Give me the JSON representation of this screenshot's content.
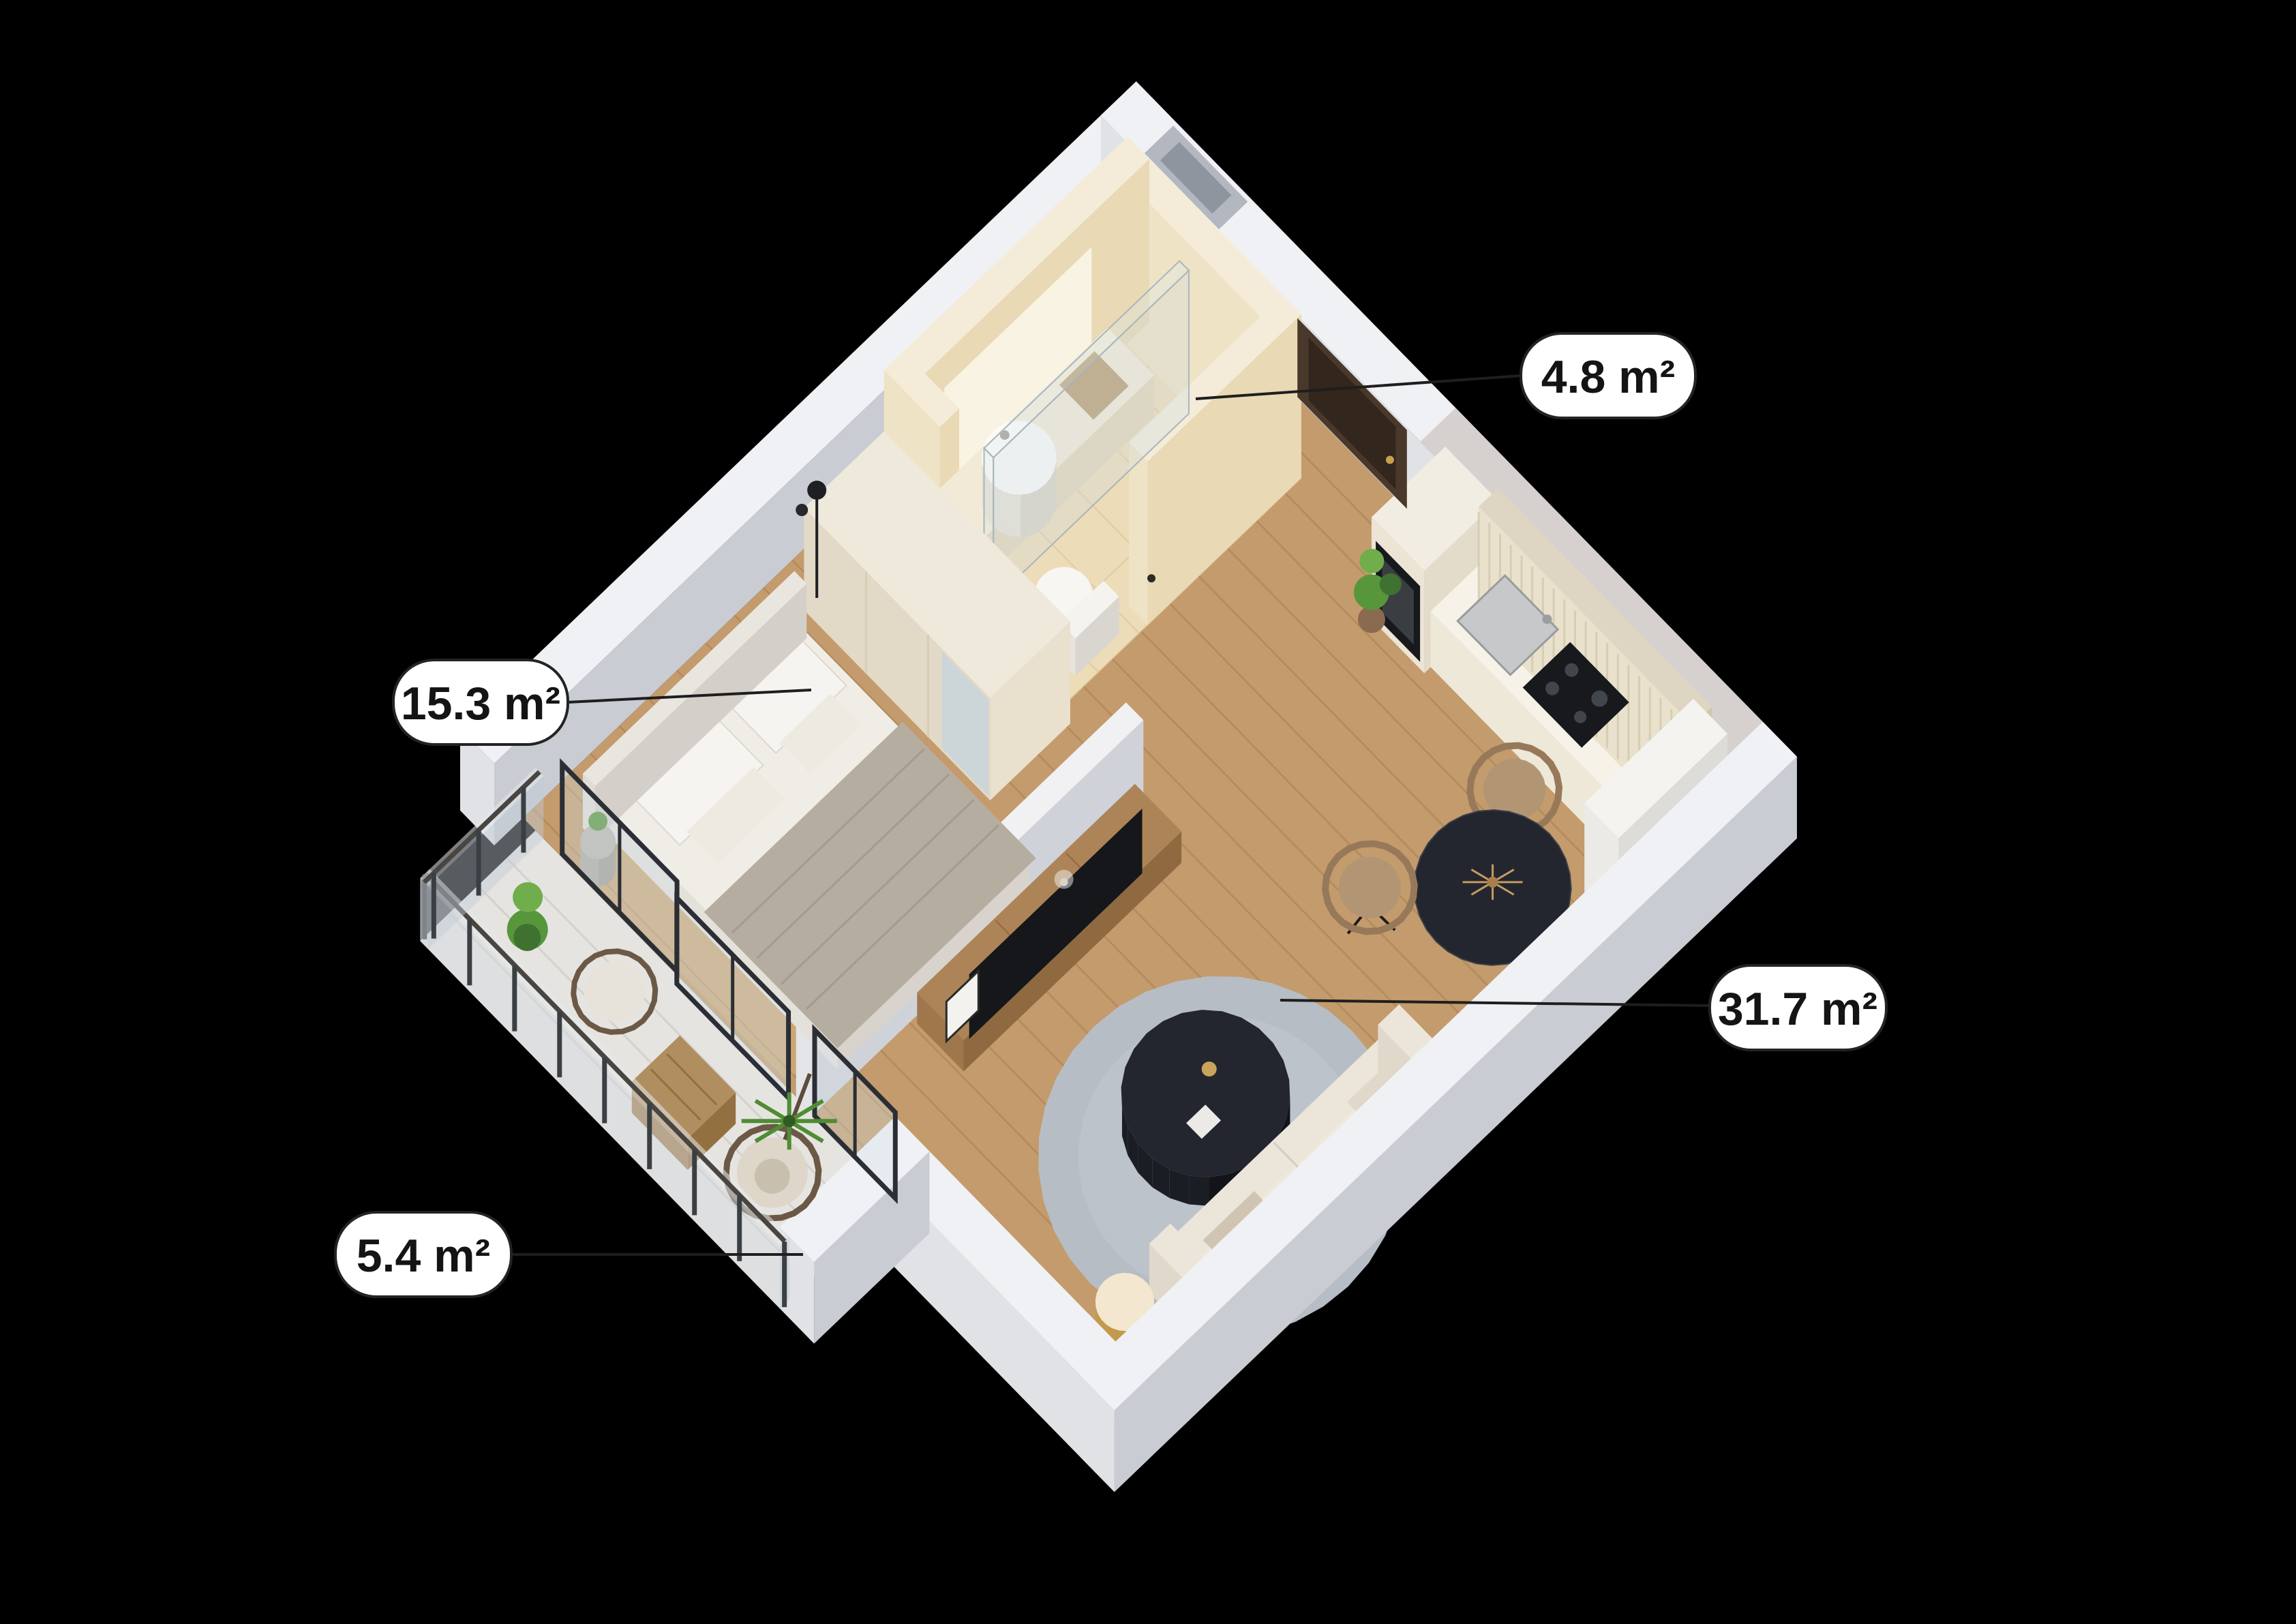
{
  "page": {
    "background": "#000000"
  },
  "floorplan": {
    "areas": [
      {
        "text": "4.8 m²"
      },
      {
        "text": "15.3 m²"
      },
      {
        "text": "31.7 m²"
      },
      {
        "text": "5.4 m²"
      }
    ],
    "colors": {
      "background": "#000000",
      "label_bg": "#ffffff",
      "label_text": "#141414",
      "leader_line": "#1e1e1e",
      "wall_top": "#f0f1f4",
      "wall_side_se": "#c9ccd3",
      "wall_side_sw": "#e0e2e6",
      "wood_floor": "#c49b6c",
      "wood_seam": "#a27a4c",
      "tile_floor": "#eddcb8",
      "tile_seam": "#d9c093",
      "bath_wall": "#f4ecd9",
      "bath_wall_se": "#e9d9b4",
      "bath_wall_sw": "#efe3c6",
      "balcony_floor": "#e6e4e1",
      "rug": "#b7bdc5",
      "marble_dark": "#23262e",
      "gold": "#b5914f",
      "wood_furniture": "#ad8458",
      "sofa": "#ebe5da",
      "bedding": "#f0ede7",
      "blanket": "#b6ada1",
      "glass": "#cdd6db",
      "frame_dark": "#2b2f35",
      "door_brown": "#4a392b",
      "plant_green": "#58963c",
      "plant_green_dark": "#3f7230",
      "appliance_dark": "#17191d"
    }
  }
}
